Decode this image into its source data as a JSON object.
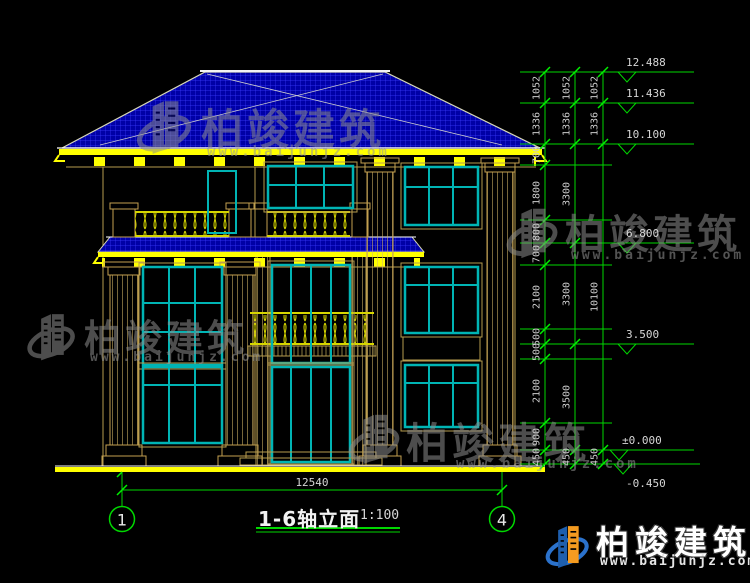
{
  "drawing": {
    "title": "1-6轴立面",
    "scale": "1:100",
    "bottom_dimension": "12540",
    "axis_markers": [
      "1",
      "4"
    ],
    "elevations": [
      "12.488",
      "11.436",
      "10.100",
      "6.800",
      "3.500",
      "±0.000",
      "-0.450"
    ],
    "dim_chains": {
      "chain_a": [
        "1052",
        "1336",
        "700",
        "1800",
        "800",
        "700",
        "2100",
        "500",
        "500",
        "2100",
        "900",
        "450"
      ],
      "chain_b": [
        "1052",
        "1336",
        "3300",
        "3300",
        "3500",
        "450"
      ],
      "chain_c": [
        "1052",
        "1336",
        "10100",
        "450"
      ]
    }
  },
  "watermark": {
    "brand": "柏竣建筑",
    "url": "www.baijunjz.com"
  },
  "footer_logo": {
    "brand": "柏竣建筑",
    "url": "www.baijunjz.com"
  },
  "colors": {
    "background": "#000000",
    "roof_blue": "#0000a6",
    "roof_grid": "#3b3bff",
    "dim_green": "#00d800",
    "accent_yellow": "#ffff00",
    "column_tan": "#c3a050",
    "window_teal": "#00b4b4",
    "railing_yellow": "#d6d600",
    "text_gray": "#cbcbcb"
  }
}
